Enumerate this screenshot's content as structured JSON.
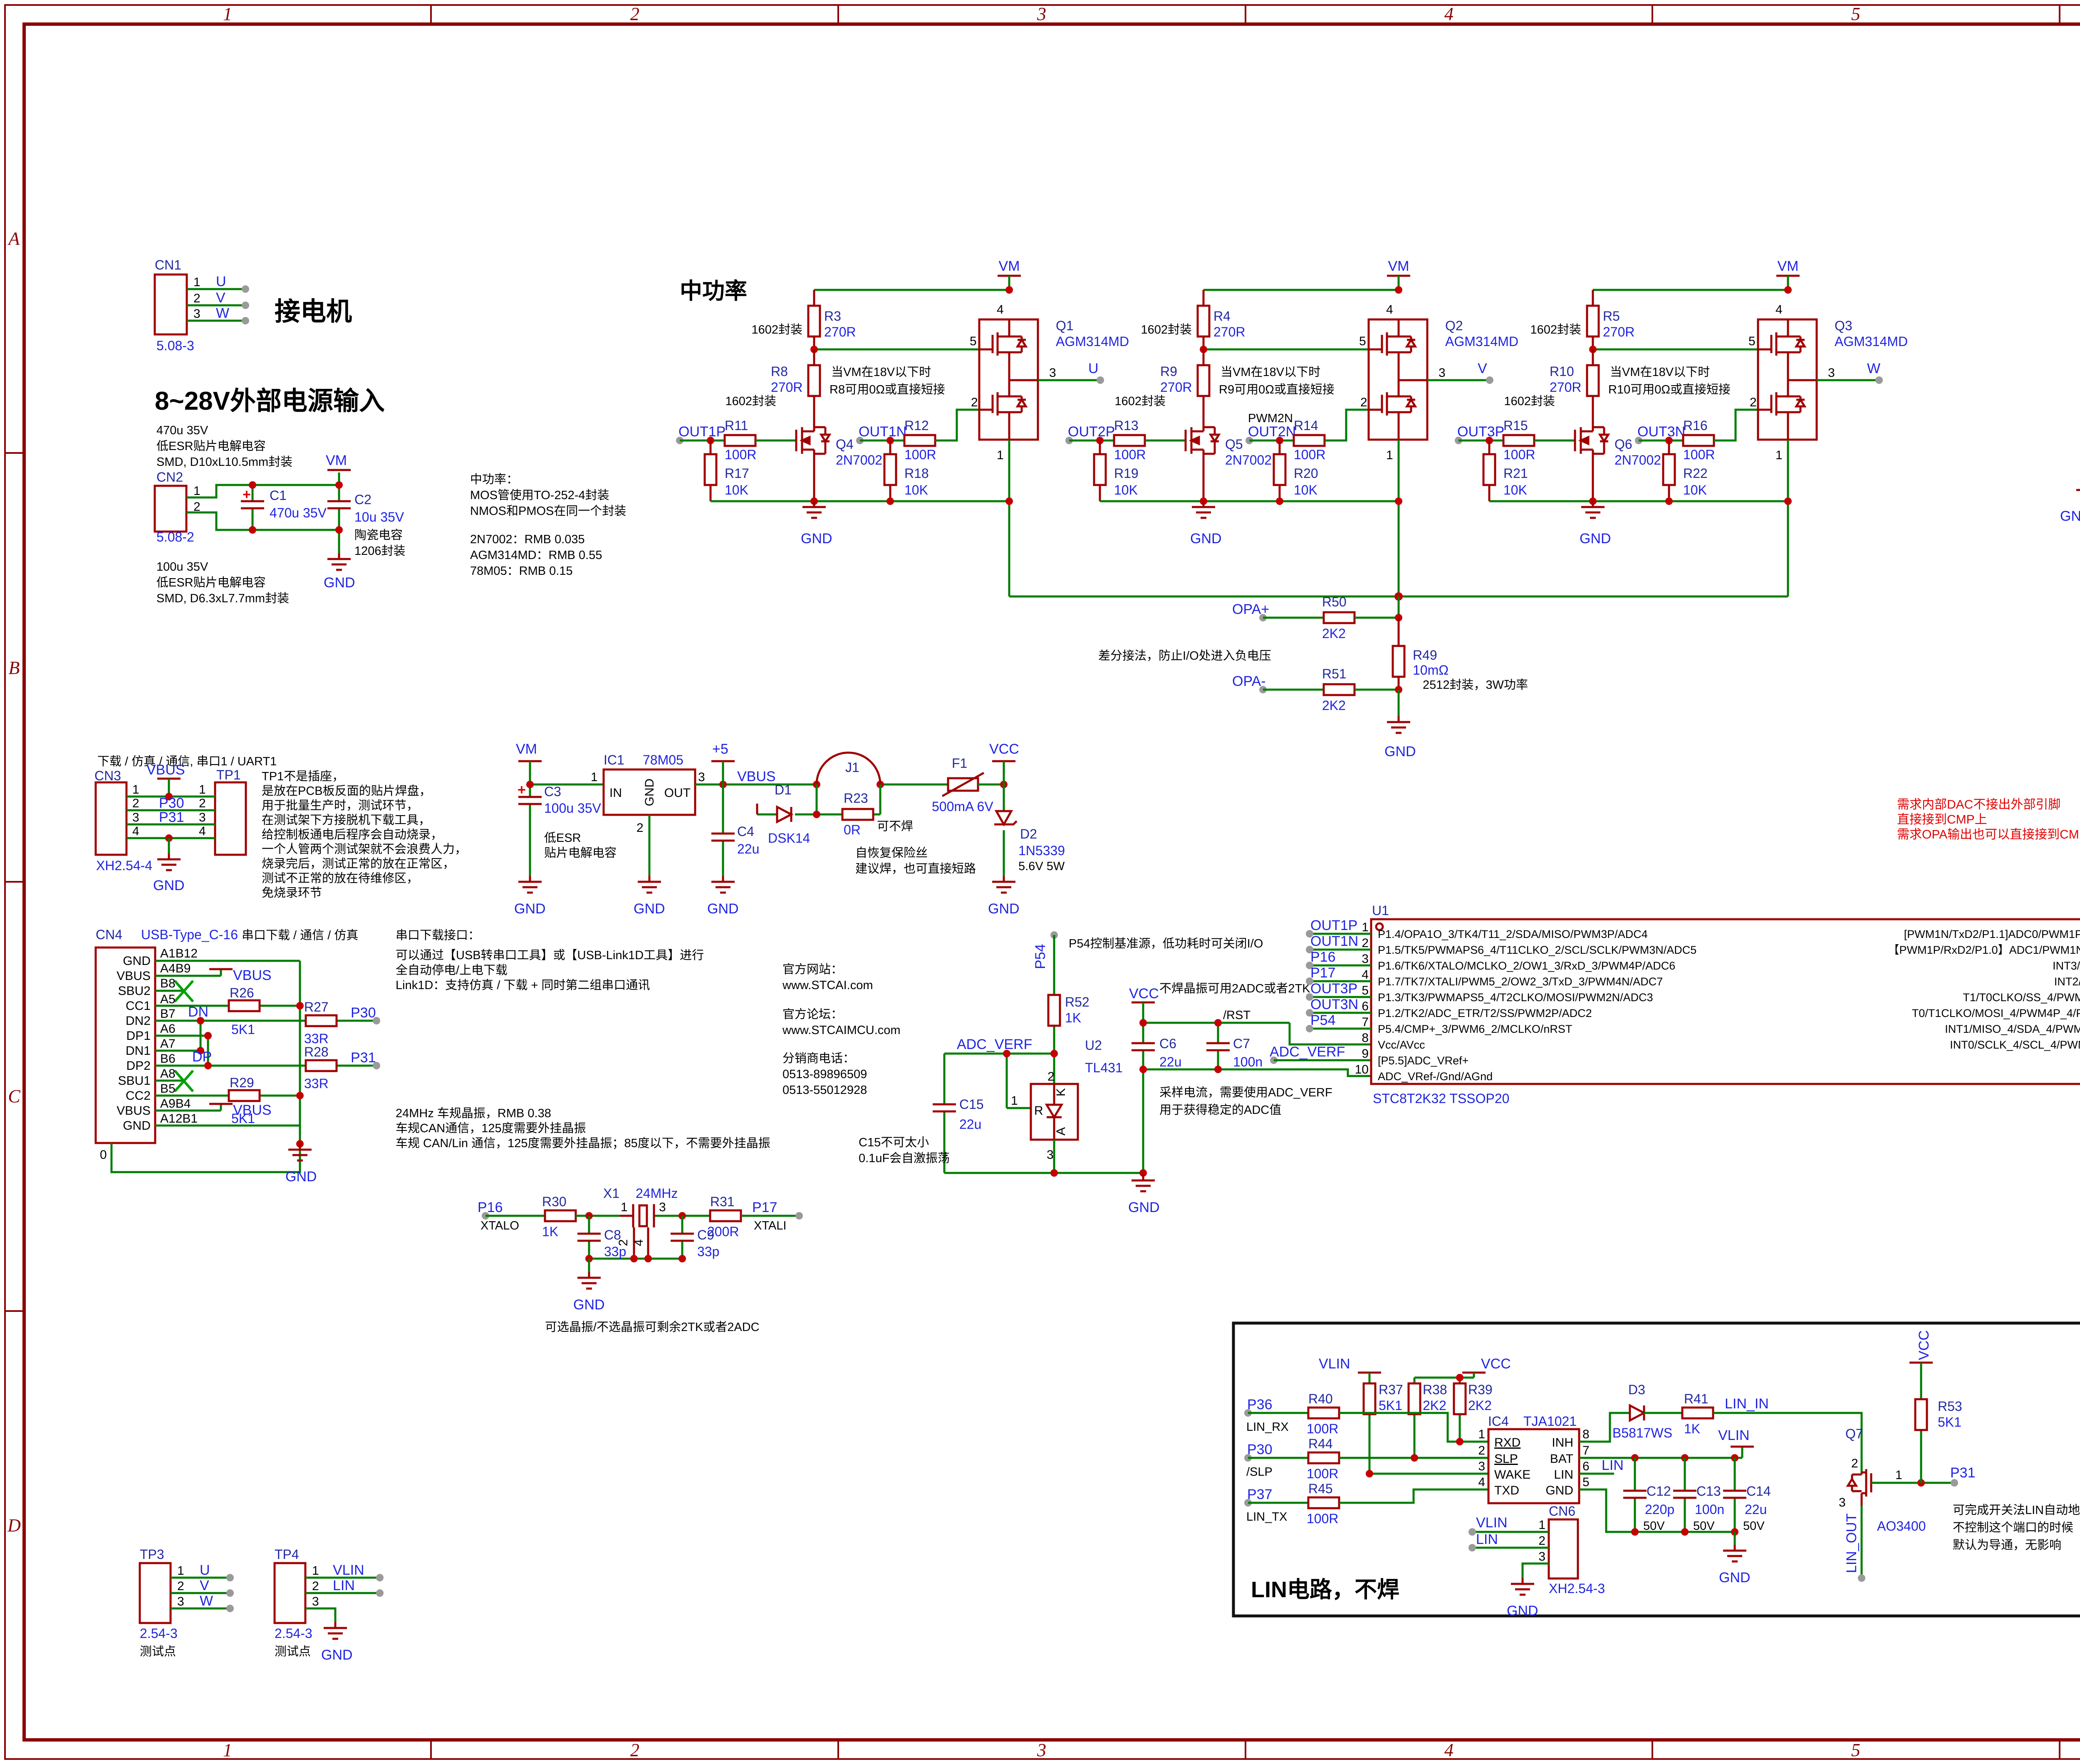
{
  "labels": {
    "gnd": "GND",
    "vm": "VM",
    "vcc": "VCC",
    "vbus": "VBUS",
    "plus5": "+5",
    "vlin": "VLIN"
  },
  "frame": {
    "cols": [
      "1",
      "2",
      "3",
      "4",
      "5",
      "6"
    ],
    "rows": [
      "A",
      "B",
      "C",
      "D"
    ]
  },
  "motor": {
    "title": "接电机",
    "ref": "CN1",
    "pins": [
      "1",
      "2",
      "3"
    ],
    "nets": [
      "U",
      "V",
      "W"
    ],
    "footprint": "5.08-3"
  },
  "power": {
    "title": "8~28V外部电源输入",
    "note_top": [
      "470u 35V",
      "低ESR贴片电解电容",
      "SMD, D10xL10.5mm封装"
    ],
    "note_bottom": [
      "100u 35V",
      "低ESR贴片电解电容",
      "SMD, D6.3xL7.7mm封装"
    ],
    "ref": "CN2",
    "pins": [
      "1",
      "2"
    ],
    "footprint": "5.08-2",
    "c1": "C1",
    "c1_val": "470u 35V",
    "c2": "C2",
    "c2_val": "10u 35V",
    "c2_n1": "陶瓷电容",
    "c2_n2": "1206封装"
  },
  "bom": [
    "中功率：",
    "MOS管使用TO-252-4封装",
    "NMOS和PMOS在同一个封装",
    "2N7002：RMB 0.035",
    "AGM314MD：RMB 0.55",
    "78M05：RMB 0.15"
  ],
  "midpower": {
    "title": "中功率",
    "phases": [
      {
        "rt": "R3",
        "rtv": "270R",
        "rm": "R8",
        "rmv": "270R",
        "pkg": "1602封装",
        "n1": "当VM在18V以下时",
        "n2": "R8可用0Ω或直接短接",
        "inp": "OUT1P",
        "extra": "",
        "rp": "R11",
        "rpv": "100R",
        "rpd": "R17",
        "rpdv": "10K",
        "qs": "Q4",
        "qsv": "2N7002",
        "inn": "OUT1N",
        "rn": "R12",
        "rnv": "100R",
        "rnd": "R18",
        "rndv": "10K",
        "q": "Q1",
        "qv": "AGM314MD",
        "out": "U",
        "p1": "1",
        "p2": "2",
        "p3": "3",
        "p4": "4",
        "p5": "5"
      },
      {
        "rt": "R4",
        "rtv": "270R",
        "rm": "R9",
        "rmv": "270R",
        "pkg": "1602封装",
        "n1": "当VM在18V以下时",
        "n2": "R9可用0Ω或直接短接",
        "inp": "OUT2P",
        "extra": "PWM2N",
        "rp": "R13",
        "rpv": "100R",
        "rpd": "R19",
        "rpdv": "10K",
        "qs": "Q5",
        "qsv": "2N7002",
        "inn": "OUT2N",
        "rn": "R14",
        "rnv": "100R",
        "rnd": "R20",
        "rndv": "10K",
        "q": "Q2",
        "qv": "AGM314MD",
        "out": "V",
        "p1": "1",
        "p2": "2",
        "p3": "3",
        "p4": "4",
        "p5": "5"
      },
      {
        "rt": "R5",
        "rtv": "270R",
        "rm": "R10",
        "rmv": "270R",
        "pkg": "1602封装",
        "n1": "当VM在18V以下时",
        "n2": "R10可用0Ω或直接短接",
        "inp": "OUT3P",
        "extra": "",
        "rp": "R15",
        "rpv": "100R",
        "rpd": "R21",
        "rpdv": "10K",
        "qs": "Q6",
        "qsv": "2N7002",
        "inn": "OUT3N",
        "rn": "R16",
        "rnv": "100R",
        "rnd": "R22",
        "rndv": "10K",
        "q": "Q3",
        "qv": "AGM314MD",
        "out": "W",
        "p1": "1",
        "p2": "2",
        "p3": "3",
        "p4": "4",
        "p5": "5"
      }
    ]
  },
  "screws": {
    "items": [
      {
        "ref": "Screws1",
        "val": "M3"
      },
      {
        "ref": "Screws2",
        "val": "M3"
      },
      {
        "ref": "Screws3",
        "val": "M3"
      },
      {
        "ref": "Screws4",
        "val": "M3"
      }
    ],
    "note": "螺丝孔"
  },
  "sense": {
    "opa_p": "OPA+",
    "r50": "R50",
    "r50v": "2K2",
    "opa_n": "OPA-",
    "r51": "R51",
    "r51v": "2K2",
    "r49": "R49",
    "r49v": "10mΩ",
    "n1": "差分接法，防止I/O处进入负电压",
    "n2": "2512封装，3W功率"
  },
  "reg": {
    "ic": "IC1",
    "icv": "78M05",
    "pin_in": "IN",
    "pin_gnd": "GND",
    "pin_out": "OUT",
    "p1": "1",
    "p2": "2",
    "p3": "3",
    "c3": "C3",
    "c3v": "100u 35V",
    "n1": "低ESR",
    "n2": "贴片电解电容",
    "c4": "C4",
    "c4v": "22u",
    "d1": "D1",
    "d1v": "DSK14",
    "j1": "J1",
    "r23": "R23",
    "r23v": "0R",
    "r23n": "可不焊",
    "f1": "F1",
    "f1v": "500mA 6V",
    "f1n1": "自恢复保险丝",
    "f1n2": "建议焊，也可直接短路",
    "d2": "D2",
    "d2v": "1N5339",
    "d2n": "5.6V 5W"
  },
  "uart": {
    "header": "下载 / 仿真 / 通信, 串口1 / UART1",
    "cn3": "CN3",
    "tp1": "TP1",
    "pins": [
      "1",
      "2",
      "3",
      "4"
    ],
    "p30": "P30",
    "p31": "P31",
    "fp": "XH2.54-4",
    "note": [
      "TP1不是插座，",
      "是放在PCB板反面的贴片焊盘，",
      "用于批量生产时，测试环节，",
      "在测试架下方接脱机下载工具，",
      "给控制板通电后程序会自动烧录，",
      "一个人管两个测试架就不会浪费人力，",
      "烧录完后，测试正常的放在正常区，",
      "测试不正常的放在待维修区，",
      "免烧录环节"
    ]
  },
  "usb": {
    "ref": "CN4",
    "val": "USB-Type_C-16",
    "desc": "串口下载 / 通信 / 仿真",
    "header": "串口下载接口：",
    "note": [
      "可以通过【USB转串口工具】或【USB-Link1D工具】进行",
      "全自动停电/上电下载",
      "Link1D：支持仿真 / 下载 + 同时第二组串口通讯"
    ],
    "names": [
      "GND",
      "VBUS",
      "SBU2",
      "CC1",
      "DN2",
      "DP1",
      "DN1",
      "DP2",
      "SBU1",
      "CC2",
      "VBUS",
      "GND"
    ],
    "des": [
      "A1B12",
      "A4B9",
      "B8",
      "A5",
      "B7",
      "A6",
      "A7",
      "B6",
      "A8",
      "B5",
      "A9B4",
      "A12B1"
    ],
    "dn": "DN",
    "dp": "DP",
    "r26": "R26",
    "r26v": "5K1",
    "r29": "R29",
    "r29v": "5K1",
    "r27": "R27",
    "r27v": "33R",
    "r28": "R28",
    "r28v": "33R",
    "p30": "P30",
    "p31": "P31",
    "shell": "0"
  },
  "info": {
    "site_l": "官方网站：",
    "site": "www.STCAI.com",
    "forum_l": "官方论坛：",
    "forum": "www.STCAIMCU.com",
    "phone_l": "分销商电话：",
    "ph1": "0513-89896509",
    "ph2": "0513-55012928"
  },
  "can_notes": [
    "24MHz 车规晶振，RMB 0.38",
    "车规CAN通信，125度需要外挂晶振",
    "车规 CAN/Lin 通信，125度需要外挂晶振；85度以下，不需要外挂晶振"
  ],
  "xtal": {
    "p16": "P16",
    "xtalo": "XTALO",
    "r30": "R30",
    "r30v": "1K",
    "x1": "X1",
    "x1v": "24MHz",
    "p1": "1",
    "p3": "3",
    "p2": "2",
    "p4": "4",
    "c8": "C8",
    "c8v": "33p",
    "c9": "C9",
    "c9v": "33p",
    "r31": "R31",
    "r31v": "200R",
    "p17": "P17",
    "xtali": "XTALI",
    "note": "可选晶振/不选晶振可剩余2TK或者2ADC"
  },
  "vref": {
    "p54": "P54",
    "top_note": "P54控制基准源，低功耗时可关闭I/O",
    "r52": "R52",
    "r52v": "1K",
    "adc": "ADC_VERF",
    "u2": "U2",
    "u2v": "TL431",
    "k": "K",
    "r": "R",
    "a": "A",
    "p1": "1",
    "p2": "2",
    "p3": "3",
    "c15": "C15",
    "c15v": "22u",
    "c15n1": "C15不可太小",
    "c15n2": "0.1uF会自激振荡",
    "mid_note": "不焊晶振可用2ADC或者2TK",
    "c6": "C6",
    "c6v": "22u",
    "c7": "C7",
    "c7v": "100n",
    "rst": "/RST",
    "an1": "采样电流，需要使用ADC_VERF",
    "an2": "用于获得稳定的ADC值"
  },
  "mcu": {
    "ref": "U1",
    "part": "STC8T2K32 TSSOP20",
    "left_nets": [
      "OUT1P",
      "OUT1N",
      "P16",
      "P17",
      "OUT3P",
      "OUT3N",
      "P54",
      "",
      "ADC_VERF",
      ""
    ],
    "left_pins": [
      "1",
      "2",
      "3",
      "4",
      "5",
      "6",
      "7",
      "8",
      "9",
      "10"
    ],
    "left_fn": [
      "P1.4/OPA1O_3/TK4/T11_2/SDA/MISO/PWM3P/ADC4",
      "P1.5/TK5/PWMAPS6_4/T11CLKO_2/SCL/SCLK/PWM3N/ADC5",
      "P1.6/TK6/XTALO/MCLKO_2/OW1_3/RxD_3/PWM4P/ADC6",
      "P1.7/TK7/XTALI/PWM5_2/OW2_3/TxD_3/PWM4N/ADC7",
      "P1.3/TK3/PWMAPS5_4/T2CLKO/MOSI/PWM2N/ADC3",
      "P1.2/TK2/ADC_ETR/T2/SS/PWM2P/ADC2",
      "P5.4/CMP+_3/PWM6_2/MCLKO/nRST",
      "Vcc/AVcc",
      "[P5.5]ADC_VRef+",
      "ADC_VRef-/Gnd/AGnd"
    ],
    "right_pins": [
      "20",
      "19",
      "18",
      "17",
      "16",
      "15",
      "14",
      "13",
      "12",
      "11"
    ],
    "right_nets": [
      "OPA-",
      "OPA+",
      "P37",
      "P36",
      "TK13",
      "OUT2P",
      "OUT2N",
      "TK14",
      "P31",
      "P30"
    ],
    "right_fn": [
      "[PWM1N/TxD2/P1.1]ADC0/PWM1P/RxD2/TK0/OPA1-_3 /P1.0",
      "【PWM1P/RxD2/P1.0】ADC1/PWM1N/TxD2/TK1/OPA1+_3/P1.1",
      "INT3/TxD_2/CMP+/OW2_2/P3.7",
      "INT2/RxD_2/CMP-/OW1_2/P3.6",
      "T1/T0CLKO/SS_4/PWMFLT/PWMFLT2/TK13/P3.5",
      "T0/T1CLKO/MOSI_4/PWM4P_4/PWM8_2/CMPO/TK12/P3.4",
      "INT1/MISO_4/SDA_4/PWM4N_4/PWM7_2/TK15/P3.3",
      "INT0/SCLK_4/SCL_4/PWMETI/PWMETI2/TK14/P3.2",
      "TxD/OW2/P3.1",
      "RxD/OW1/INT4/P3.0"
    ],
    "right_ann": [
      "",
      "",
      "USART1-LIN",
      "USART1-LIN",
      "多余2TK(TK13/TK14)",
      "",
      "",
      "多余2TK(TK13/TK14)",
      "",
      ""
    ],
    "note_top": [
      "运放+ADC采样电流并进行软件限流",
      "外部不再独立接限流部分"
    ],
    "note_red": [
      "需求内部DAC不接出外部引脚",
      "直接接到CMP上",
      "需求OPA输出也可以直接接到CMP上"
    ],
    "note_mid": [
      "内部可通过DAC+OPA输出给CMP比较",
      "CMP的输出通过内部PWM直接完成过流关断",
      "（可参见STC32G144K的比较器输入选择，可选DACO）",
      "（可参见STC32G144K的PWMFLT输入选择，可选CMPO）"
    ],
    "note_bottom": [
      "下载口复用为LIN的额外控制引脚",
      "不使用LIN时可用于通讯或者调试"
    ]
  },
  "lin": {
    "title": "LIN电路，不焊",
    "p36": "P36",
    "lin_rx": "LIN_RX",
    "r40": "R40",
    "r40v": "100R",
    "p30": "P30",
    "slp": "/SLP",
    "r44": "R44",
    "r44v": "100R",
    "p37": "P37",
    "lin_tx": "LIN_TX",
    "r45": "R45",
    "r45v": "100R",
    "r37": "R37",
    "r37v": "5K1",
    "r38": "R38",
    "r38v": "2K2",
    "r39": "R39",
    "r39v": "2K2",
    "ic4": "IC4",
    "ic4v": "TJA1021",
    "lp": [
      "RXD",
      "SLP",
      "WAKE",
      "TXD"
    ],
    "rp": [
      "INH",
      "BAT",
      "LIN",
      "GND"
    ],
    "lpn": [
      "1",
      "2",
      "3",
      "4"
    ],
    "rpn": [
      "8",
      "7",
      "6",
      "5"
    ],
    "d3": "D3",
    "d3v": "B5817WS",
    "r41": "R41",
    "r41v": "1K",
    "lin_in": "LIN_IN",
    "lin_net": "LIN",
    "c12": "C12",
    "c12v": "220p",
    "c12u": "50V",
    "c13": "C13",
    "c13v": "100n",
    "c13u": "50V",
    "c14": "C14",
    "c14v": "22u",
    "c14u": "50V",
    "q7": "Q7",
    "q7v": "AO3400",
    "q7p": [
      "2",
      "1",
      "3"
    ],
    "r53": "R53",
    "r53v": "5K1",
    "p31": "P31",
    "lin_out": "LIN_OUT",
    "note": [
      "可完成开关法LIN自动地址识别",
      "不控制这个端口的时候",
      "默认为导通，无影响"
    ],
    "cn6": "CN6",
    "cn6fp": "XH2.54-3",
    "cn6p": [
      "1",
      "2",
      "3"
    ],
    "cn6_vlin": "VLIN",
    "cn6_lin": "LIN"
  },
  "tp": {
    "tp3": "TP3",
    "tp3_nets": [
      "U",
      "V",
      "W"
    ],
    "tp4": "TP4",
    "tp4_nets": [
      "VLIN",
      "LIN"
    ],
    "pins": [
      "1",
      "2",
      "3"
    ],
    "fp": "2.54-3",
    "label": "测试点"
  }
}
